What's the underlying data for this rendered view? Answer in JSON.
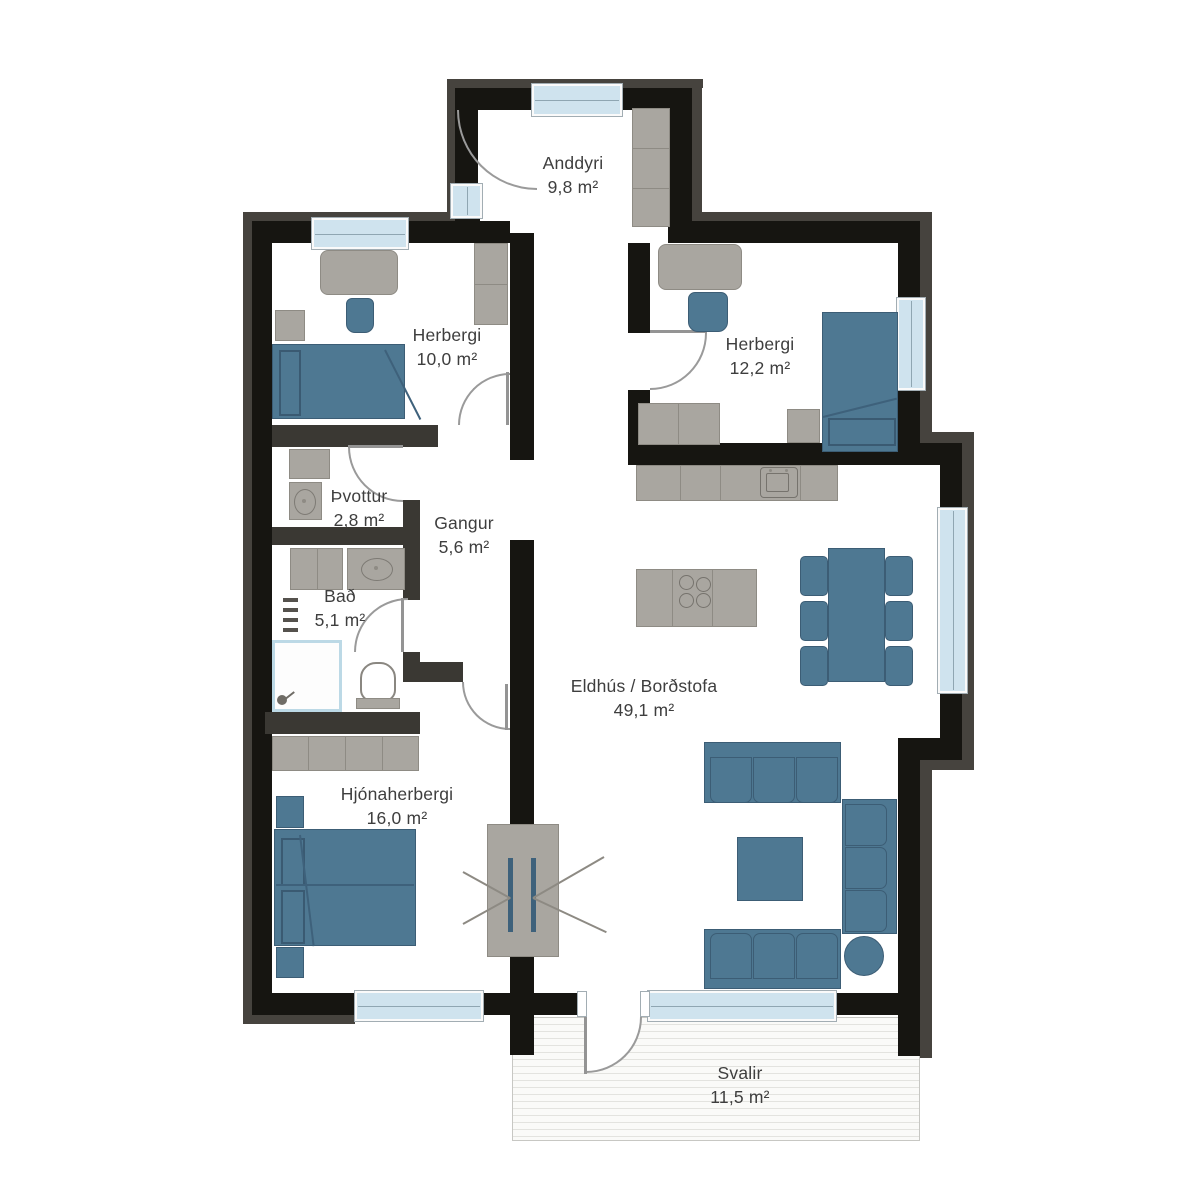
{
  "plan": {
    "title": "Apartment floor plan",
    "rooms": [
      {
        "id": "anddyri",
        "name": "Anddyri",
        "area": "9,8 m²"
      },
      {
        "id": "herbergi-10",
        "name": "Herbergi",
        "area": "10,0 m²"
      },
      {
        "id": "herbergi-12",
        "name": "Herbergi",
        "area": "12,2 m²"
      },
      {
        "id": "thvottur",
        "name": "Þvottur",
        "area": "2,8 m²"
      },
      {
        "id": "gangur",
        "name": "Gangur",
        "area": "5,6 m²"
      },
      {
        "id": "bad",
        "name": "Bað",
        "area": "5,1 m²"
      },
      {
        "id": "eldhus",
        "name": "Eldhús / Borðstofa",
        "area": "49,1 m²"
      },
      {
        "id": "hjonaherbergi",
        "name": "Hjónaherbergi",
        "area": "16,0 m²"
      },
      {
        "id": "svalir",
        "name": "Svalir",
        "area": "11,5 m²"
      }
    ],
    "colors": {
      "wall": "#161511",
      "partition": "#3a3833",
      "outer_band": "#46433e",
      "furniture_gray": "#a9a6a0",
      "furniture_blue": "#4e7892",
      "window_glass": "#cfe3ee",
      "text": "#3e3e3e"
    }
  }
}
